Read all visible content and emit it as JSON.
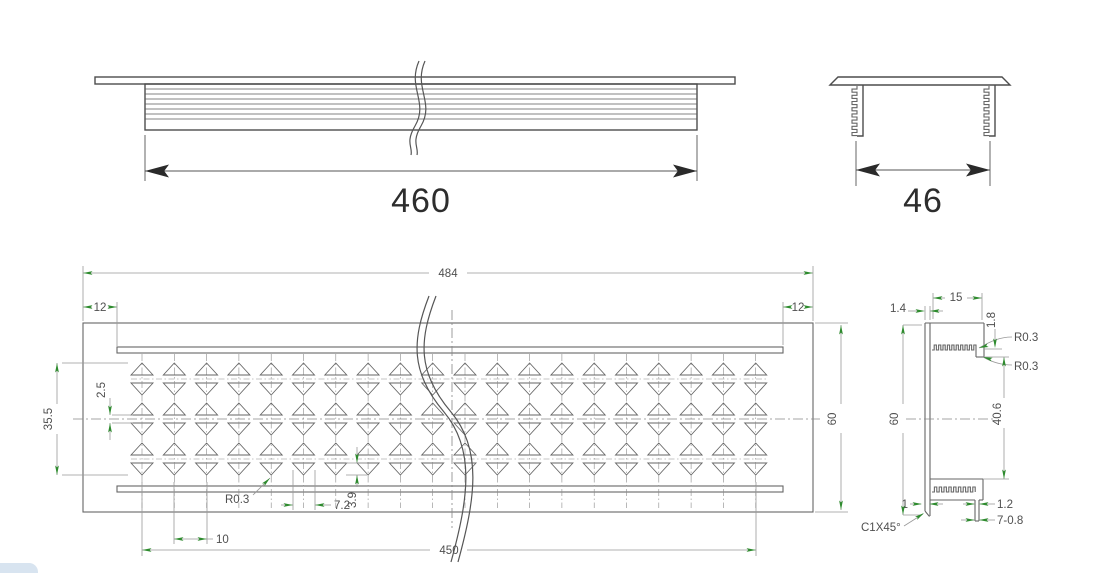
{
  "drawing": {
    "top_view": {
      "length_label": "460"
    },
    "end_view": {
      "width_label": "46"
    },
    "plan_view": {
      "overall_length": "484",
      "end_margin_left": "12",
      "end_margin_right": "12",
      "width": "60",
      "pattern_height": "35.5",
      "center_gap": "2.5",
      "corner_radius": "R0.3",
      "hole_width": "7.2",
      "hole_height": "3.9",
      "hole_pitch": "10",
      "pattern_length": "450"
    },
    "section_view": {
      "flange_width": "15",
      "top_thickness": "1.4",
      "lip_thickness": "1.8",
      "radius_top": "R0.3",
      "radius_bottom": "R0.3",
      "height": "60",
      "inner_height": "40.6",
      "bottom_thickness": "1",
      "tab_width": "1.2",
      "fin_spec": "7-0.8",
      "chamfer": "C1X45°"
    }
  },
  "pattern": {
    "columns": 20,
    "first_col_x": 142,
    "col_pitch_px": 32.3,
    "row_centers_y": [
      379,
      419,
      459
    ],
    "tri_half_width": 11,
    "tri_height": 12,
    "half_gap": 4,
    "cl_top": 354,
    "cl_bottom": 508
  },
  "colors": {
    "accent_green": "#2e8b2e",
    "black_arrow": "#2a2a2a",
    "line_gray": "#666666",
    "dim_gray": "#999999",
    "cad_text": "#4f4f4f",
    "artifact_blue": "#d8e4f0"
  }
}
